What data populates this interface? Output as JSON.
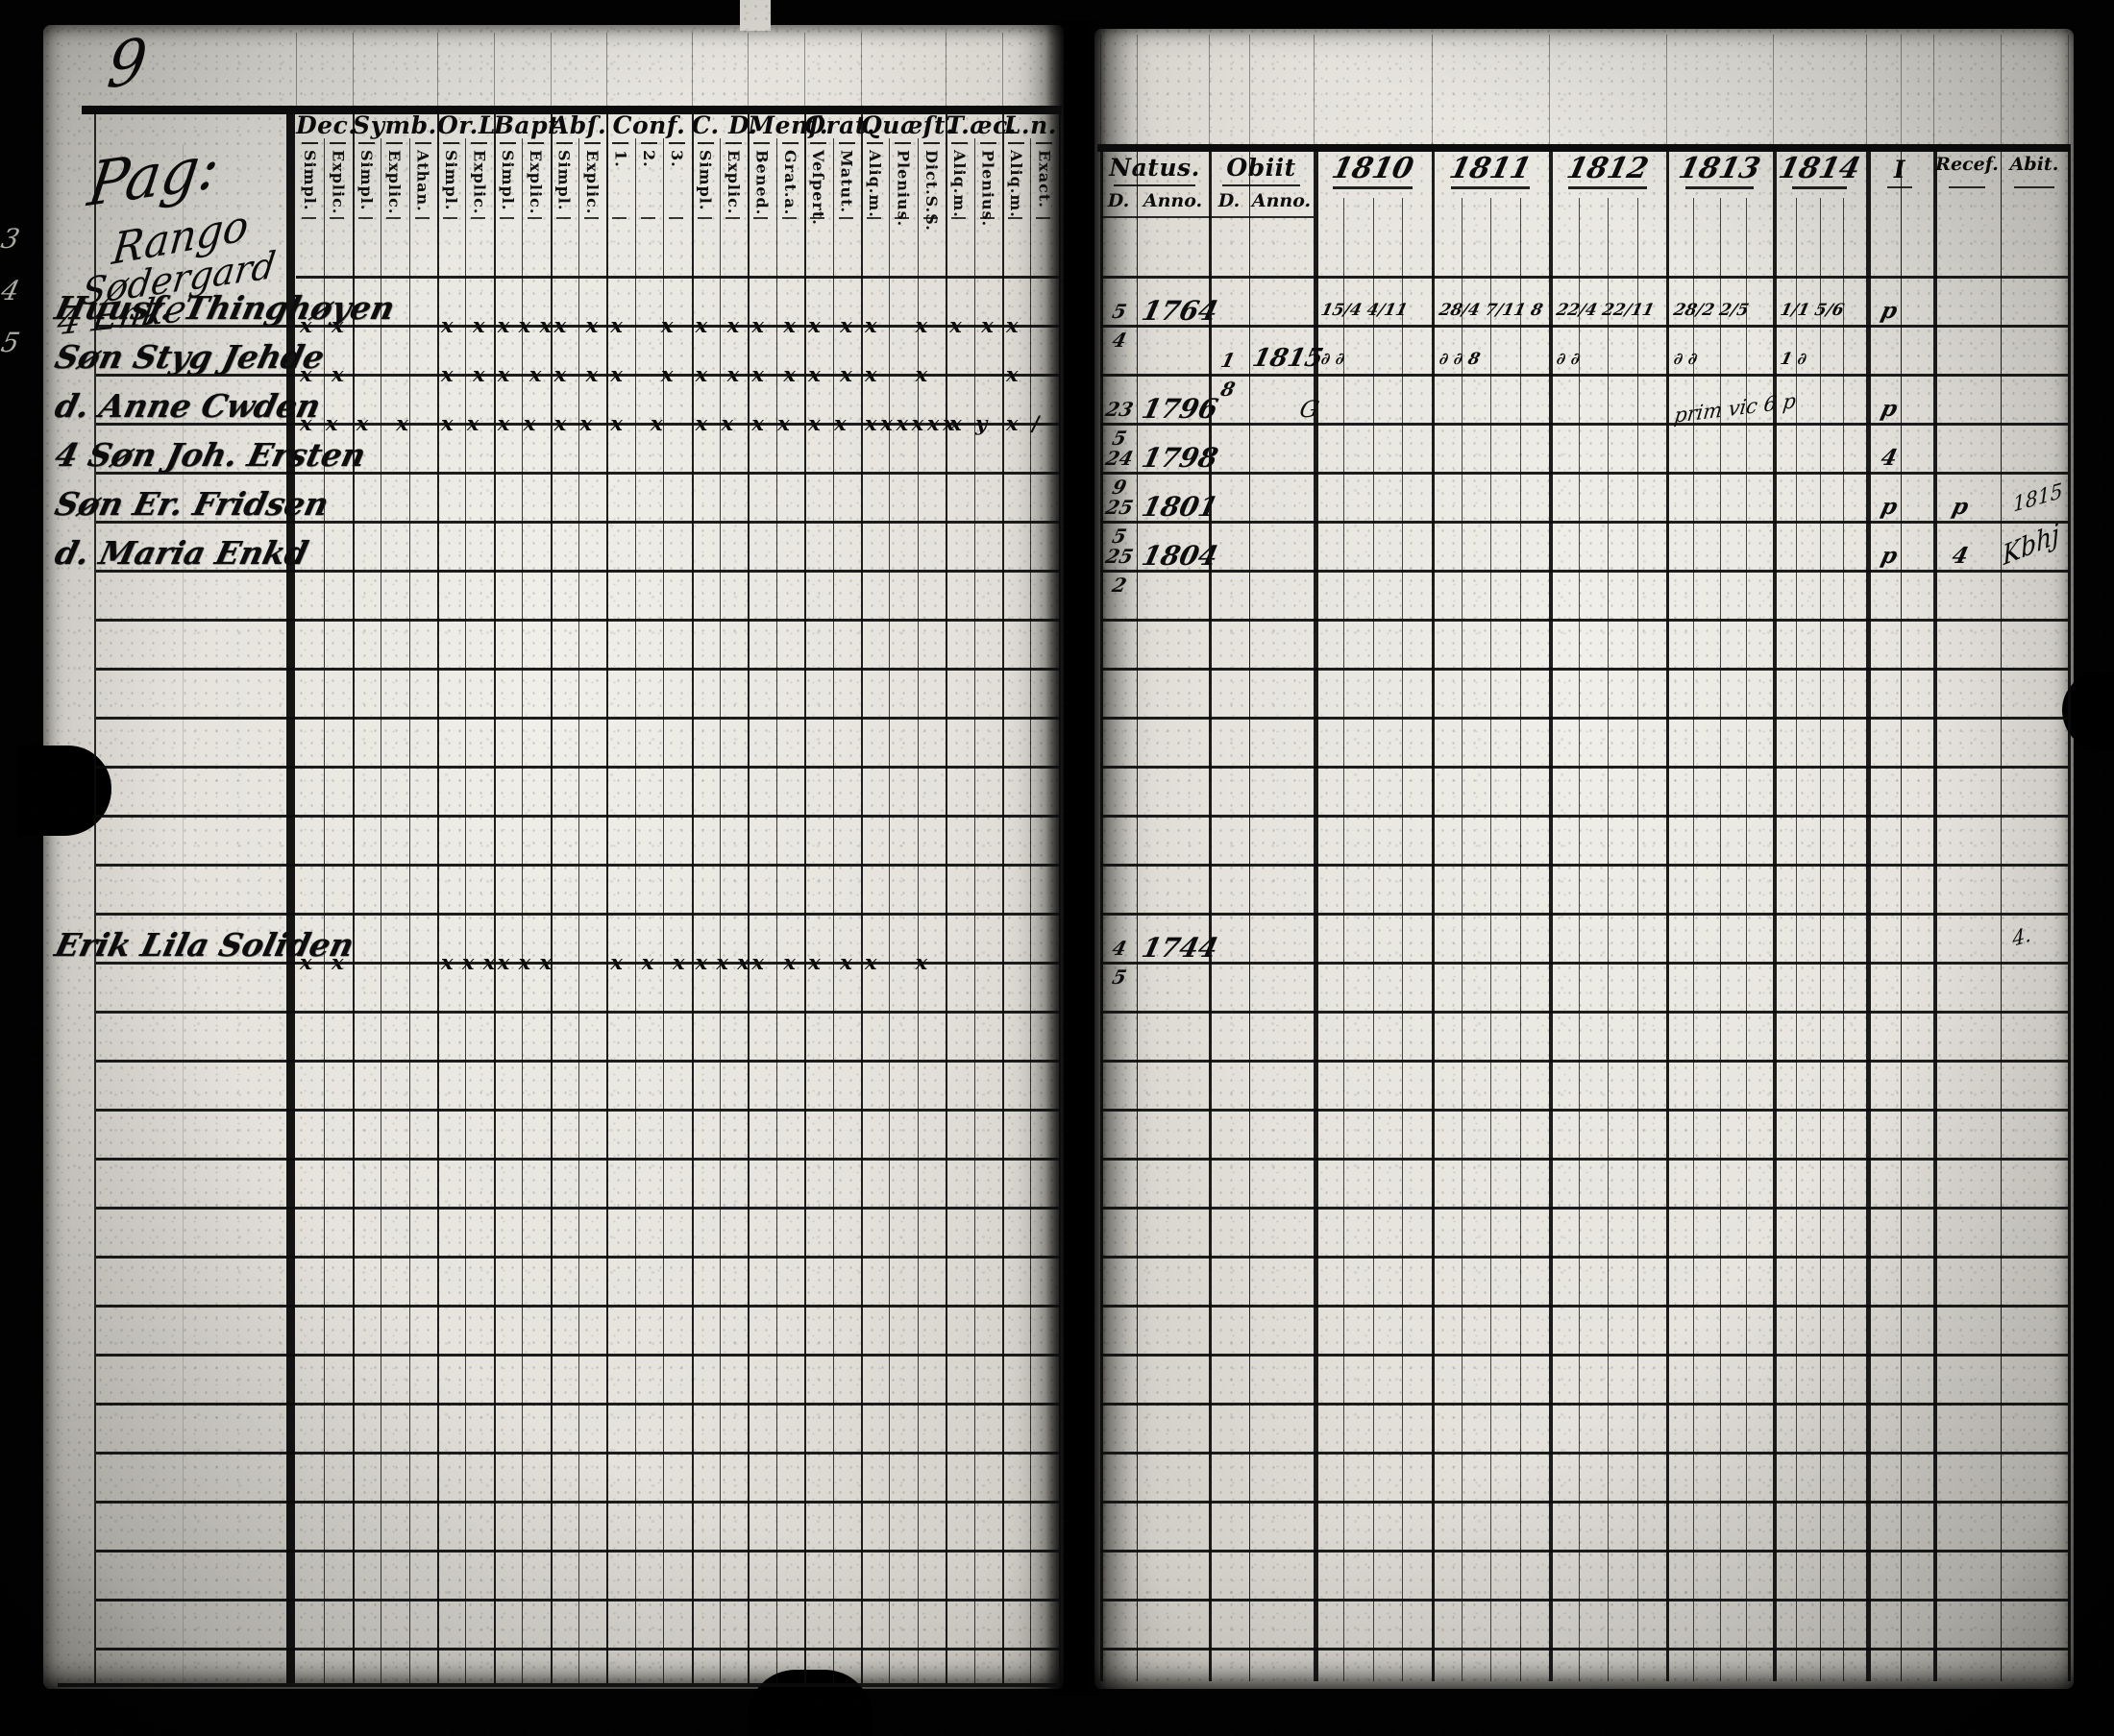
{
  "page_number": "9",
  "left_page": {
    "margin_scribbles": [
      {
        "text": "Pag:"
      },
      {
        "text": "Rango"
      },
      {
        "text": "Sødergard"
      },
      {
        "text": "4 Enke"
      }
    ],
    "columns": [
      {
        "label": "Dec.",
        "subs": [
          "Simpl.",
          "Explic."
        ]
      },
      {
        "label": "Symb.",
        "subs": [
          "Simpl.",
          "Explic.",
          "Athan."
        ]
      },
      {
        "label": "Or.L",
        "subs": [
          "Simpl.",
          "Explic."
        ]
      },
      {
        "label": "Bapt.",
        "subs": [
          "Simpl.",
          "Explic."
        ]
      },
      {
        "label": "Abſ.",
        "subs": [
          "Simpl.",
          "Explic."
        ]
      },
      {
        "label": "Conf.",
        "subs": [
          "1.",
          "2.",
          "3."
        ]
      },
      {
        "label": "C. D.",
        "subs": [
          "Simpl.",
          "Explic."
        ]
      },
      {
        "label": "Menſ.",
        "subs": [
          "Bened.",
          "Grat.a."
        ]
      },
      {
        "label": "Orat.",
        "subs": [
          "Veſpert.",
          "Matut."
        ]
      },
      {
        "label": "Quæſt.",
        "subs": [
          "Aliq.m.",
          "Plenius.",
          "Dict.S.S."
        ]
      },
      {
        "label": "T.æc.",
        "subs": [
          "Aliq.m.",
          "Plenius."
        ]
      },
      {
        "label": "L.n.",
        "subs": [
          "Aliq.m.",
          "Exact."
        ]
      }
    ],
    "rows": [
      {
        "row": 1,
        "name": "Huusf. Thinghøyen",
        "marks": [
          "x x",
          "",
          "x x",
          "x x x",
          "x x",
          "x x",
          "x x",
          "x x",
          "x x",
          "x x",
          "x x",
          "x"
        ]
      },
      {
        "row": 2,
        "name": "Søn Styg Jehde",
        "marks": [
          "x x",
          "",
          "x x",
          "x x",
          "x x",
          "x x",
          "x x",
          "x x",
          "x x",
          "x x",
          "",
          "x"
        ]
      },
      {
        "row": 3,
        "name": "d. Anne Cwden",
        "marks": [
          "xx",
          "xx",
          "xx",
          "xx",
          "xx",
          "xx",
          "xx",
          "xx",
          "xx",
          "xxxxxx",
          "xy",
          "x/"
        ]
      },
      {
        "row": 4,
        "name": "4 Søn Joh. Ersten",
        "marks": []
      },
      {
        "row": 5,
        "name": "Søn Er. Fridsen",
        "marks": []
      },
      {
        "row": 6,
        "name": "d. Maria Enkd",
        "marks": []
      },
      {
        "row": 14,
        "name": "Erik Lila Soliden",
        "marks": [
          "x x",
          "",
          "x x x",
          "x x x",
          "",
          "x x x",
          "x x x",
          "x x",
          "x x",
          "x x",
          "",
          ""
        ]
      }
    ],
    "edge_marks": [
      "3",
      "4",
      "5"
    ]
  },
  "right_page": {
    "natus_label": "Natus.",
    "obiit_label": "Obiit",
    "d_label": "D.",
    "anno_label": "Anno.",
    "years": [
      "1810",
      "1811",
      "1812",
      "1813",
      "1814"
    ],
    "extra_column": "I",
    "recef_label": "Recef.",
    "abit_label": "Abit.",
    "rows": [
      {
        "row": 1,
        "natus_day": "5",
        "natus_month": "4",
        "natus_anno": "1764",
        "year_marks": {
          "1810": "15/4  4/11",
          "1811": "28/4  7/11  8",
          "1812": "22/4  22/11",
          "1813": "28/2  2/5",
          "1814": "1/1  5/6"
        },
        "i_mark": "p"
      },
      {
        "row": 2,
        "obiit_day": "1",
        "obiit_month": "8",
        "obiit_anno": "1815",
        "year_marks": {
          "1810": "∂  ∂",
          "1811": "∂  ∂  8",
          "1812": "∂  ∂",
          "1813": "∂  ∂",
          "1814": "1  ∂"
        }
      },
      {
        "row": 3,
        "natus_day": "23",
        "natus_month": "5",
        "natus_anno": "1796",
        "pre_mark": "G",
        "note_1814": "prim vic 6 p",
        "margin_note": "1815",
        "margin_note2": "Kbhj",
        "i_mark": "p"
      },
      {
        "row": 4,
        "natus_day": "24",
        "natus_month": "9",
        "natus_anno": "1798",
        "i_mark": "4"
      },
      {
        "row": 5,
        "natus_day": "25",
        "natus_month": "5",
        "natus_anno": "1801",
        "i_mark": "p",
        "recef_mark": "p"
      },
      {
        "row": 6,
        "natus_day": "25",
        "natus_month": "2",
        "natus_anno": "1804",
        "i_mark": "p",
        "recef_mark": "4"
      },
      {
        "row": 14,
        "natus_day": "4",
        "natus_month": "5",
        "natus_anno": "1744",
        "margin_note": "4."
      }
    ]
  }
}
